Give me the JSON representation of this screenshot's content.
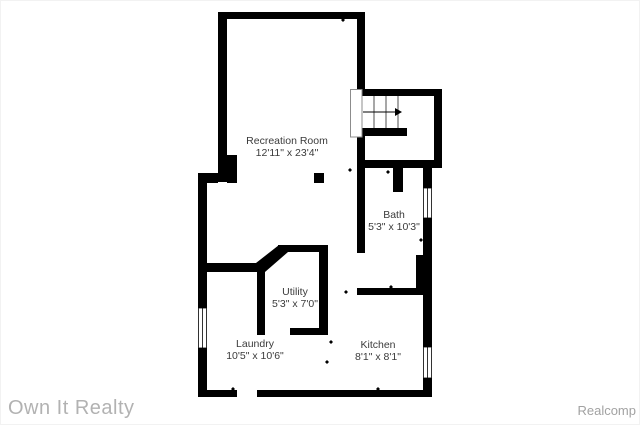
{
  "plan": {
    "rooms": [
      {
        "id": "recreation-room",
        "name": "Recreation Room",
        "dimensions": "12'11\" x 23'4\""
      },
      {
        "id": "bath",
        "name": "Bath",
        "dimensions": "5'3\" x 10'3\""
      },
      {
        "id": "utility",
        "name": "Utility",
        "dimensions": "5'3\" x 7'0\""
      },
      {
        "id": "laundry",
        "name": "Laundry",
        "dimensions": "10'5\" x 10'6\""
      },
      {
        "id": "kitchen",
        "name": "Kitchen",
        "dimensions": "8'1\" x 8'1\""
      }
    ],
    "features": [
      "staircase-with-up-arrow",
      "windows",
      "door-markers",
      "support-post"
    ]
  },
  "watermarks": {
    "agency": "Own It Realty",
    "provider": "Realcomp"
  },
  "colors": {
    "wall": "#000000",
    "room_label": "#3b3b3b",
    "agency_watermark": "#b2b2b2",
    "provider_watermark": "#a2a2a2",
    "background": "#ffffff"
  }
}
